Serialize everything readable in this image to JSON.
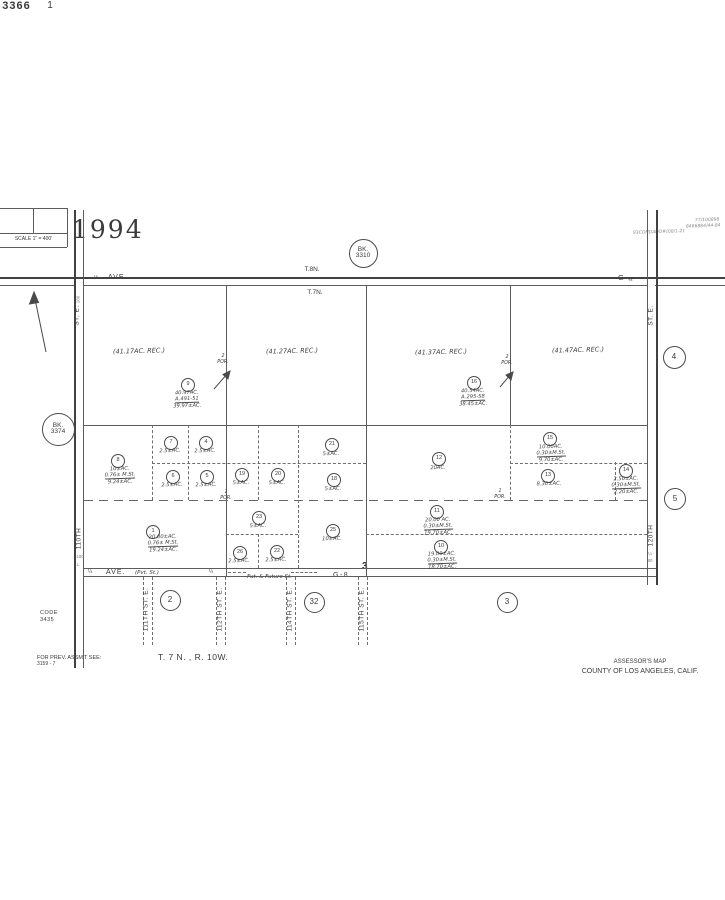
{
  "sheet": {
    "book": "3366",
    "page": "1",
    "scale_label": "SCALE 1\" = 400'",
    "year": "1994",
    "notes": [
      "77/100898",
      "8466884/44-84",
      "93CONDADO#(00/1-21"
    ]
  },
  "townships": {
    "north": "T.8N.",
    "south": "T.7N."
  },
  "roads": {
    "top_ave_left": "AVE.",
    "top_ave_left_tick": "⅛",
    "top_ave_right": "G",
    "top_ave_right_tick": "⅛",
    "left_st": "ST. E.",
    "left_no": "110TH",
    "right_st": "ST. E.",
    "right_no": "120TH",
    "bottom": {
      "q1": "¼",
      "ave": "AVE.",
      "pvt": "(Pvt. St.)",
      "q2": "¼",
      "future": "Fut. & Future St.",
      "g8": "G-8",
      "section": "3"
    }
  },
  "book_circles": [
    {
      "l1": "BK.",
      "l2": "3310",
      "x": 362,
      "y": 252,
      "d": 27
    },
    {
      "l1": "BK.",
      "l2": "3374",
      "x": 57,
      "y": 428,
      "d": 31
    }
  ],
  "section_circles": [
    {
      "n": "4",
      "x": 673,
      "y": 356,
      "d": 21
    },
    {
      "n": "5",
      "x": 674,
      "y": 498,
      "d": 20
    },
    {
      "n": "2",
      "x": 169,
      "y": 599,
      "d": 19
    },
    {
      "n": "32",
      "x": 313,
      "y": 601,
      "d": 19
    },
    {
      "n": "3",
      "x": 506,
      "y": 601,
      "d": 19
    }
  ],
  "rec_labels": [
    {
      "text": "(41.17AC. REC.)",
      "x": 139,
      "y": 352
    },
    {
      "text": "(41.27AC. REC.)",
      "x": 292,
      "y": 352
    },
    {
      "text": "(41.37AC. REC.)",
      "x": 441,
      "y": 353
    },
    {
      "text": "(41.47AC. REC.)",
      "x": 578,
      "y": 351
    }
  ],
  "parcels": [
    {
      "n": "9",
      "x": 187,
      "y": 384,
      "tx": 187,
      "ty": 390,
      "lines": [
        "40.97AC.",
        "A.491-51",
        "39.97±AC."
      ]
    },
    {
      "n": "16",
      "x": 473,
      "y": 382,
      "tx": 473,
      "ty": 388,
      "lines": [
        "40.54AC.",
        "A.295-58",
        "38.45±AC."
      ]
    },
    {
      "n": "8",
      "x": 117,
      "y": 460,
      "tx": 120,
      "ty": 466,
      "lines": [
        "10±AC.",
        "0.76± M.St.",
        "9.24±AC."
      ]
    },
    {
      "n": "7",
      "x": 170,
      "y": 442,
      "tx": 170,
      "ty": 448,
      "lines": [
        "2.5±AC."
      ]
    },
    {
      "n": "4",
      "x": 205,
      "y": 442,
      "tx": 205,
      "ty": 448,
      "lines": [
        "2.5±AC."
      ]
    },
    {
      "n": "6",
      "x": 172,
      "y": 476,
      "tx": 172,
      "ty": 482,
      "lines": [
        "2.5±AC."
      ]
    },
    {
      "n": "5",
      "x": 206,
      "y": 476,
      "tx": 206,
      "ty": 482,
      "lines": [
        "2.5±AC."
      ]
    },
    {
      "n": "19",
      "x": 241,
      "y": 474,
      "tx": 241,
      "ty": 480,
      "lines": [
        "5±AC."
      ]
    },
    {
      "n": "20",
      "x": 277,
      "y": 474,
      "tx": 277,
      "ty": 480,
      "lines": [
        "5±AC."
      ]
    },
    {
      "n": "21",
      "x": 331,
      "y": 444,
      "tx": 331,
      "ty": 451,
      "lines": [
        "5±AC."
      ]
    },
    {
      "n": "18",
      "x": 333,
      "y": 479,
      "tx": 333,
      "ty": 486,
      "lines": [
        "5±AC."
      ]
    },
    {
      "n": "12",
      "x": 438,
      "y": 458,
      "tx": 438,
      "ty": 465,
      "lines": [
        "20AC."
      ]
    },
    {
      "n": "15",
      "x": 549,
      "y": 438,
      "tx": 551,
      "ty": 444,
      "lines": [
        "10.00AC.",
        "0.30±M.St.",
        "9.70±AC."
      ]
    },
    {
      "n": "13",
      "x": 547,
      "y": 475,
      "tx": 549,
      "ty": 481,
      "lines": [
        "8.30±AC."
      ]
    },
    {
      "n": "14",
      "x": 625,
      "y": 470,
      "tx": 626,
      "ty": 476,
      "lines": [
        "2.50±AC.",
        "0.30±M.St.",
        "2.20±AC."
      ]
    },
    {
      "n": "1",
      "x": 152,
      "y": 531,
      "tx": 163,
      "ty": 534,
      "lines": [
        "20.00±AC.",
        "0.76± M.St.",
        "19.24±AC."
      ]
    },
    {
      "n": "23",
      "x": 258,
      "y": 517,
      "tx": 258,
      "ty": 523,
      "lines": [
        "5±AC."
      ]
    },
    {
      "n": "26",
      "x": 239,
      "y": 552,
      "tx": 239,
      "ty": 558,
      "lines": [
        "2.5±AC."
      ]
    },
    {
      "n": "22",
      "x": 276,
      "y": 551,
      "tx": 276,
      "ty": 557,
      "lines": [
        "2.5±AC."
      ]
    },
    {
      "n": "25",
      "x": 332,
      "y": 530,
      "tx": 332,
      "ty": 536,
      "lines": [
        "10±AC."
      ]
    },
    {
      "n": "11",
      "x": 436,
      "y": 511,
      "tx": 438,
      "ty": 517,
      "lines": [
        "20.00 AC.",
        "0.30±M.St.",
        "19.70±AC."
      ]
    },
    {
      "n": "10",
      "x": 440,
      "y": 546,
      "tx": 442,
      "ty": 551,
      "lines": [
        "19.00±AC.",
        "0.30±M.St.",
        "18.70±AC."
      ]
    }
  ],
  "por_labels": [
    {
      "a": "2",
      "b": "POR.",
      "x": 223,
      "y": 354
    },
    {
      "a": "2",
      "b": "POR.",
      "x": 507,
      "y": 355
    },
    {
      "a": "1",
      "b": "POR.",
      "x": 226,
      "y": 490
    },
    {
      "a": "1",
      "b": "POR.",
      "x": 500,
      "y": 489
    }
  ],
  "future_streets": [
    {
      "label": "111TH ST. E.",
      "cx": 146,
      "x1": 143,
      "x2": 152
    },
    {
      "label": "112TH ST. E.",
      "cx": 220,
      "x1": 216,
      "x2": 225
    },
    {
      "label": "114TH ST. E.",
      "cx": 290,
      "x1": 286,
      "x2": 295
    },
    {
      "label": "115TH ST. E.",
      "cx": 362,
      "x1": 358,
      "x2": 367
    }
  ],
  "ticks": [
    {
      "t": "160",
      "x": 79,
      "y": 297,
      "rot": true
    },
    {
      "t": "100",
      "x": 80,
      "y": 555,
      "rot": false
    },
    {
      "t": "L",
      "x": 78,
      "y": 563,
      "rot": false
    },
    {
      "t": "¼",
      "x": 650,
      "y": 552,
      "rot": false
    },
    {
      "t": "80",
      "x": 650,
      "y": 559,
      "rot": false
    }
  ],
  "footer": {
    "code_l1": "CODE",
    "code_l2": "3435",
    "prev_l1": "FOR PREV. ASSM'T SEE:",
    "prev_l2": "3159 - 7",
    "township_range": "T. 7 N. , R. 10W.",
    "assessor_l1": "ASSESSOR'S MAP",
    "assessor_l2": "COUNTY OF LOS ANGELES, CALIF."
  }
}
